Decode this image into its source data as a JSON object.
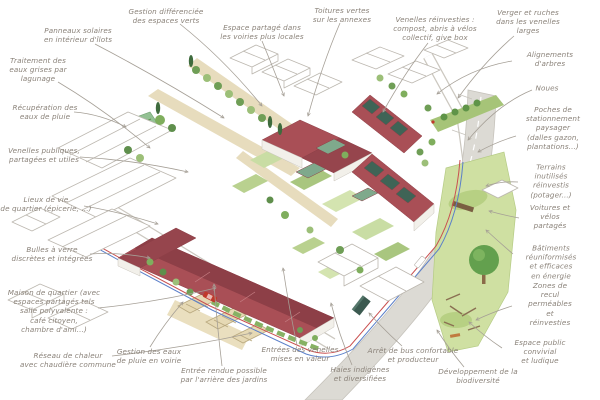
{
  "diagram": {
    "type": "annotated-axonometric-neighborhood-plan",
    "palette": {
      "roof_red": "#a94f56",
      "roof_red_dark": "#8d3f47",
      "solar_panel_teal": "#3f6456",
      "green_roof": "#7fa98c",
      "tree_green_dark": "#5f8f4c",
      "tree_green_light": "#9cbf78",
      "park_green": "#cfe0a2",
      "path_beige": "#e7dcbd",
      "road_grey": "#dcdad4",
      "network_red": "#c94f4f",
      "network_blue": "#5b7fc9",
      "annotation_text": "#8a8279",
      "leader_line": "#a59f96"
    },
    "annotations": [
      {
        "name": "gestion-differenciee",
        "text": "Gestion différenciée\ndes espaces verts",
        "x": 166,
        "y": 16
      },
      {
        "name": "panneaux-solaires",
        "text": "Panneaux solaires\nen intérieur d'îlots",
        "x": 78,
        "y": 35
      },
      {
        "name": "espace-partage",
        "text": "Espace partagé dans\nles voiries plus locales",
        "x": 262,
        "y": 32
      },
      {
        "name": "toitures-vertes",
        "text": "Toitures vertes\nsur les annexes",
        "x": 342,
        "y": 15
      },
      {
        "name": "venelles-reinvesties",
        "text": "Venelles réinvesties :\ncompost, abris à vélos\ncollectif, give box",
        "x": 435,
        "y": 29
      },
      {
        "name": "verger-ruches",
        "text": "Verger et ruches\ndans les venelles\nlarges",
        "x": 528,
        "y": 22
      },
      {
        "name": "alignements-arbres",
        "text": "Alignements d'arbres",
        "x": 550,
        "y": 59
      },
      {
        "name": "traitement-eaux-grises",
        "text": "Traitement des\neaux grises par\nlagunage",
        "x": 38,
        "y": 70
      },
      {
        "name": "noues",
        "text": "Noues",
        "x": 547,
        "y": 88
      },
      {
        "name": "recuperation-eaux",
        "text": "Récupération des\neaux de pluie",
        "x": 45,
        "y": 112
      },
      {
        "name": "poches-stationnement",
        "text": "Poches de\nstationnement\npaysager (dalles gazon,\nplantations...)",
        "x": 553,
        "y": 128
      },
      {
        "name": "venelles-publiques",
        "text": "Venelles publiques,\npartagées et utiles",
        "x": 44,
        "y": 155
      },
      {
        "name": "terrains-inutilises",
        "text": "Terrains inutilisés\nréinvestis (potager...)",
        "x": 551,
        "y": 181
      },
      {
        "name": "lieux-de-vie",
        "text": "Lieux de vie\nde quartier (épicerie, ...)",
        "x": 46,
        "y": 204
      },
      {
        "name": "voitures-velos",
        "text": "Voitures et\nvélos partagés",
        "x": 550,
        "y": 217
      },
      {
        "name": "bulles-a-verre",
        "text": "Bulles à verre\ndiscrètes et intégrées",
        "x": 52,
        "y": 254
      },
      {
        "name": "batiments-energie",
        "text": "Bâtiments\nréuniformisés et efficaces\nen énergie",
        "x": 551,
        "y": 262
      },
      {
        "name": "maison-de-quartier",
        "text": "Maison de quartier (avec\nespaces partagés tels\nsalle polyvalente :\ncafé citoyen,\nchambre d'ami...)",
        "x": 54,
        "y": 311
      },
      {
        "name": "zones-de-recul",
        "text": "Zones de recul\nperméables et\nréinvesties",
        "x": 550,
        "y": 304
      },
      {
        "name": "espace-public",
        "text": "Espace public convivial\net ludique",
        "x": 540,
        "y": 352
      },
      {
        "name": "reseau-chaleur",
        "text": "Réseau de chaleur\navec chaudière commune",
        "x": 68,
        "y": 360
      },
      {
        "name": "gestion-eaux-voirie",
        "text": "Gestion des eaux\nde pluie en voirie",
        "x": 149,
        "y": 356
      },
      {
        "name": "entree-rendue",
        "text": "Entrée rendue possible\npar l'arrière des jardins",
        "x": 224,
        "y": 375
      },
      {
        "name": "entrees-venelles",
        "text": "Entrées des venelles\nmises en valeur",
        "x": 300,
        "y": 354
      },
      {
        "name": "arret-bus",
        "text": "Arrêt de bus confortable\net producteur",
        "x": 413,
        "y": 355
      },
      {
        "name": "haies-indigenes",
        "text": "Haies indigènes\net diversifiées",
        "x": 360,
        "y": 374
      },
      {
        "name": "developpement-biodiversite",
        "text": "Développement de la\nbiodiversité",
        "x": 478,
        "y": 376
      }
    ]
  }
}
